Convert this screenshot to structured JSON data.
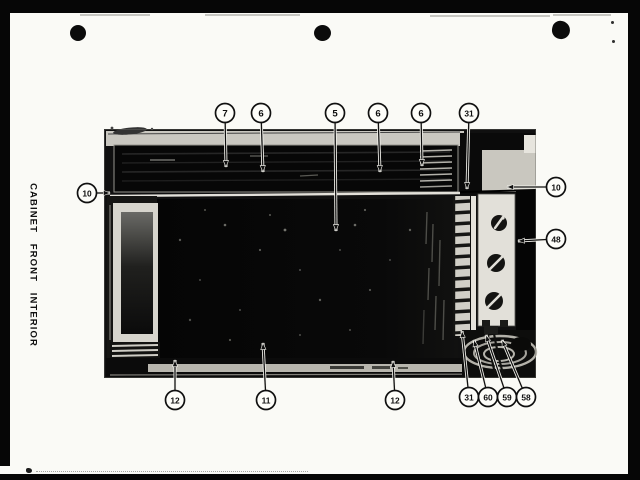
{
  "document": {
    "side_label": "CABINET FRONT INTERIOR"
  },
  "figure": {
    "callouts": [
      {
        "label": "7",
        "cx": 225,
        "cy": 113,
        "tx": 226,
        "ty": 167
      },
      {
        "label": "6",
        "cx": 261,
        "cy": 113,
        "tx": 263,
        "ty": 172
      },
      {
        "label": "5",
        "cx": 335,
        "cy": 113,
        "tx": 336,
        "ty": 231
      },
      {
        "label": "6",
        "cx": 378,
        "cy": 113,
        "tx": 380,
        "ty": 172
      },
      {
        "label": "6",
        "cx": 421,
        "cy": 113,
        "tx": 422,
        "ty": 166
      },
      {
        "label": "31",
        "cx": 469,
        "cy": 113,
        "tx": 467,
        "ty": 189
      },
      {
        "label": "10",
        "cx": 87,
        "cy": 193,
        "tx": 110,
        "ty": 193
      },
      {
        "label": "10",
        "cx": 556,
        "cy": 187,
        "tx": 507,
        "ty": 187
      },
      {
        "label": "48",
        "cx": 556,
        "cy": 239,
        "tx": 518,
        "ty": 241
      },
      {
        "label": "12",
        "cx": 175,
        "cy": 400,
        "tx": 175,
        "ty": 360
      },
      {
        "label": "11",
        "cx": 266,
        "cy": 400,
        "tx": 263,
        "ty": 343
      },
      {
        "label": "12",
        "cx": 395,
        "cy": 400,
        "tx": 393,
        "ty": 361
      },
      {
        "label": "31",
        "cx": 469,
        "cy": 397,
        "tx": 462,
        "ty": 331
      },
      {
        "label": "60",
        "cx": 488,
        "cy": 397,
        "tx": 474,
        "ty": 340
      },
      {
        "label": "59",
        "cx": 507,
        "cy": 397,
        "tx": 486,
        "ty": 335
      },
      {
        "label": "58",
        "cx": 526,
        "cy": 397,
        "tx": 502,
        "ty": 340
      }
    ]
  },
  "colors": {
    "paper": "#fafaf6",
    "ink": "#101010",
    "photo_black": "#0a0a0a"
  }
}
